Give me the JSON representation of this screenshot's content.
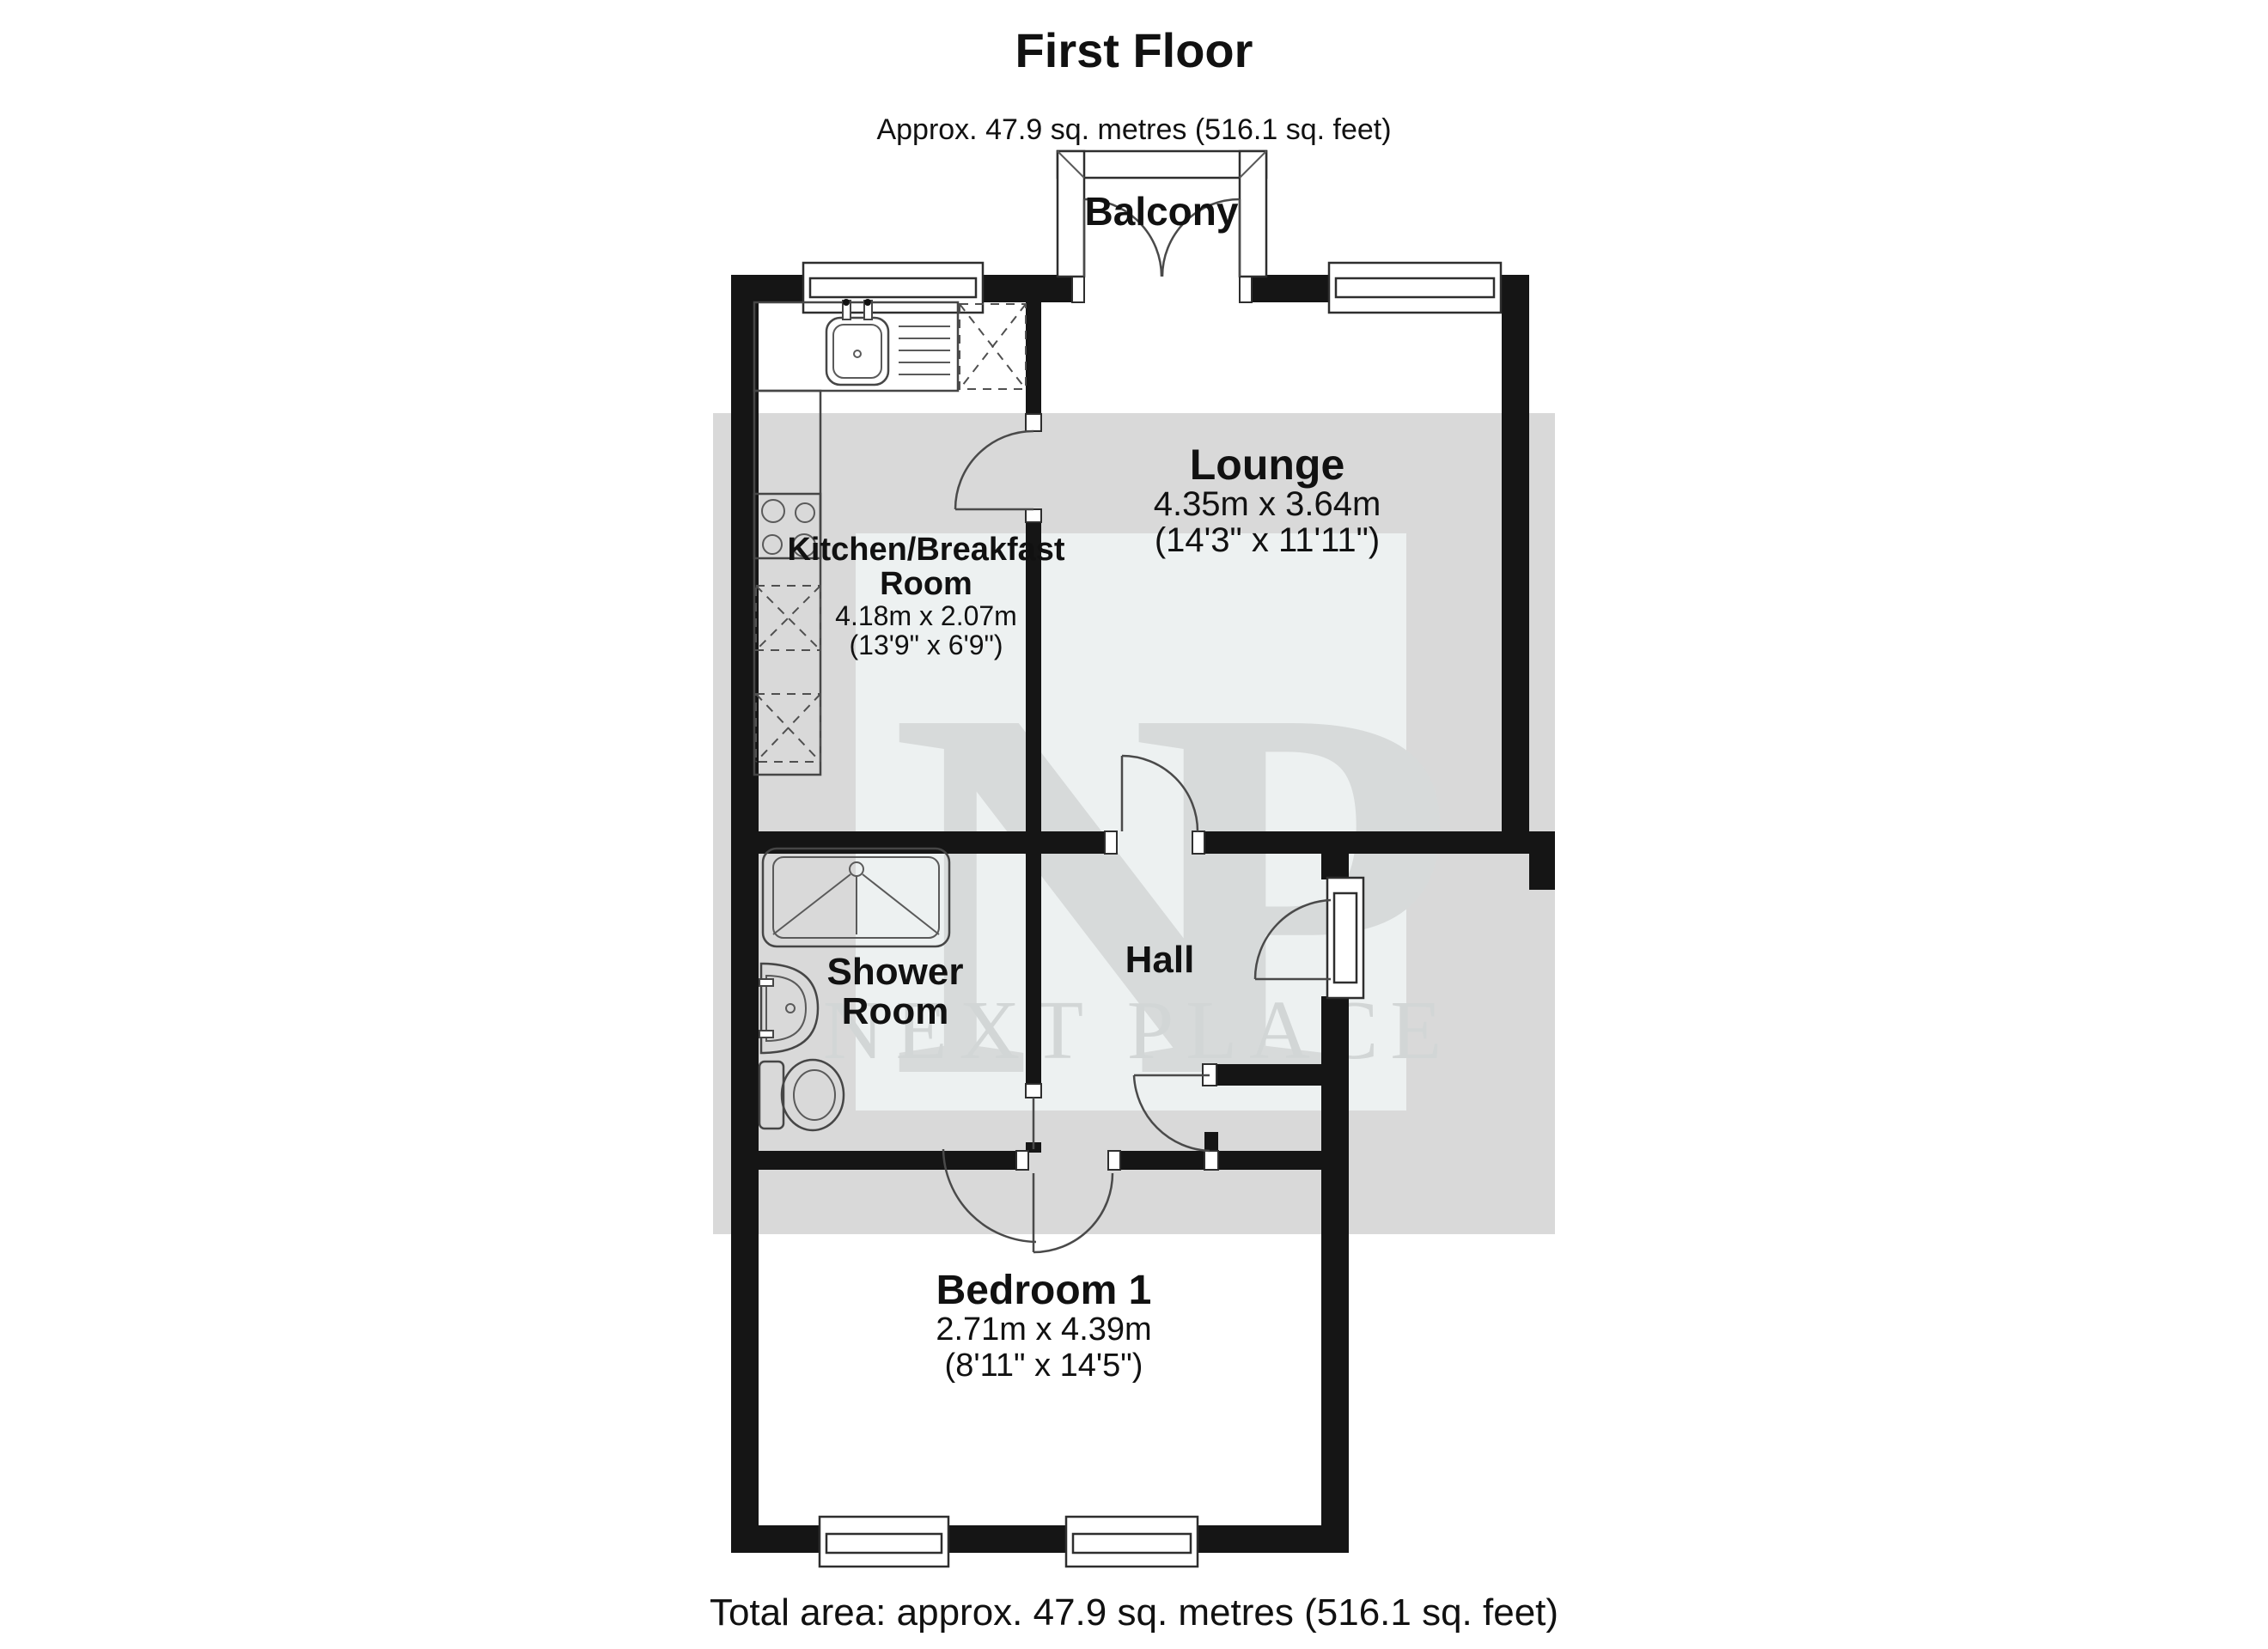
{
  "title": {
    "heading": "First Floor",
    "subtitle": "Approx. 47.9 sq. metres (516.1 sq. feet)"
  },
  "footer": {
    "total_area": "Total area: approx. 47.9 sq. metres (516.1 sq. feet)"
  },
  "watermark": {
    "initial_n": "N",
    "initial_p": "P",
    "brand": "NEXT PLACE",
    "band_color": "#d9d9d9",
    "box_color": "#edf1f1",
    "letter_color": "#d7dada",
    "brand_color": "#d2d6d6"
  },
  "rooms": {
    "balcony": {
      "name": "Balcony"
    },
    "lounge": {
      "name": "Lounge",
      "metric": "4.35m x 3.64m",
      "imperial": "(14'3\" x 11'11\")"
    },
    "kitchen": {
      "name_line1": "Kitchen/Breakfast",
      "name_line2": "Room",
      "metric": "4.18m x 2.07m",
      "imperial": "(13'9\" x 6'9\")"
    },
    "shower": {
      "name_line1": "Shower",
      "name_line2": "Room"
    },
    "hall": {
      "name": "Hall"
    },
    "bedroom": {
      "name": "Bedroom 1",
      "metric": "2.71m x 4.39m",
      "imperial": "(8'11\" x 14'5\")"
    }
  }
}
